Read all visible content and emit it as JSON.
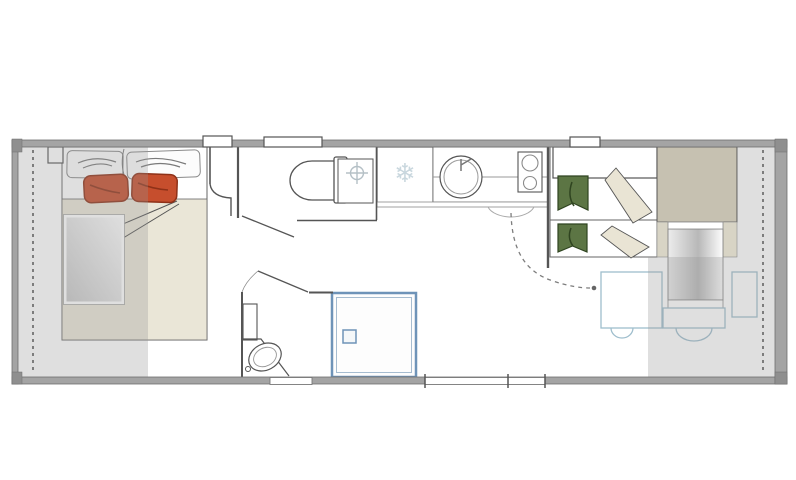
{
  "plan": {
    "colors": {
      "wall": "#a4a4a4",
      "wall_edge": "#6f6f6f",
      "corner_cap": "#8f8f8f",
      "floor": "#ffffff",
      "overlay_gray": "rgba(150,150,150,0.30)",
      "dashed_line": "#7d7d7d",
      "outline": "#555555",
      "pillow_red": "#c64e2d",
      "pillow_red_stroke": "#8e3118",
      "pillow_green": "#5c7544",
      "pillow_green_stroke": "#2f4420",
      "bedding_beige": "#eae6d7",
      "blanket_fold_beige": "#e9e4d4",
      "wardrobe_taupe": "#c6c1b1",
      "side_taupe": "#d8d4c5",
      "furniture_blue": "#9fbecd",
      "shower_blue": "#6e93b8",
      "freezer_icon_color": "#c9d7de",
      "heater_icon_color": "#b5c0c6"
    },
    "icons": {
      "freezer_glyph": "❄"
    }
  }
}
